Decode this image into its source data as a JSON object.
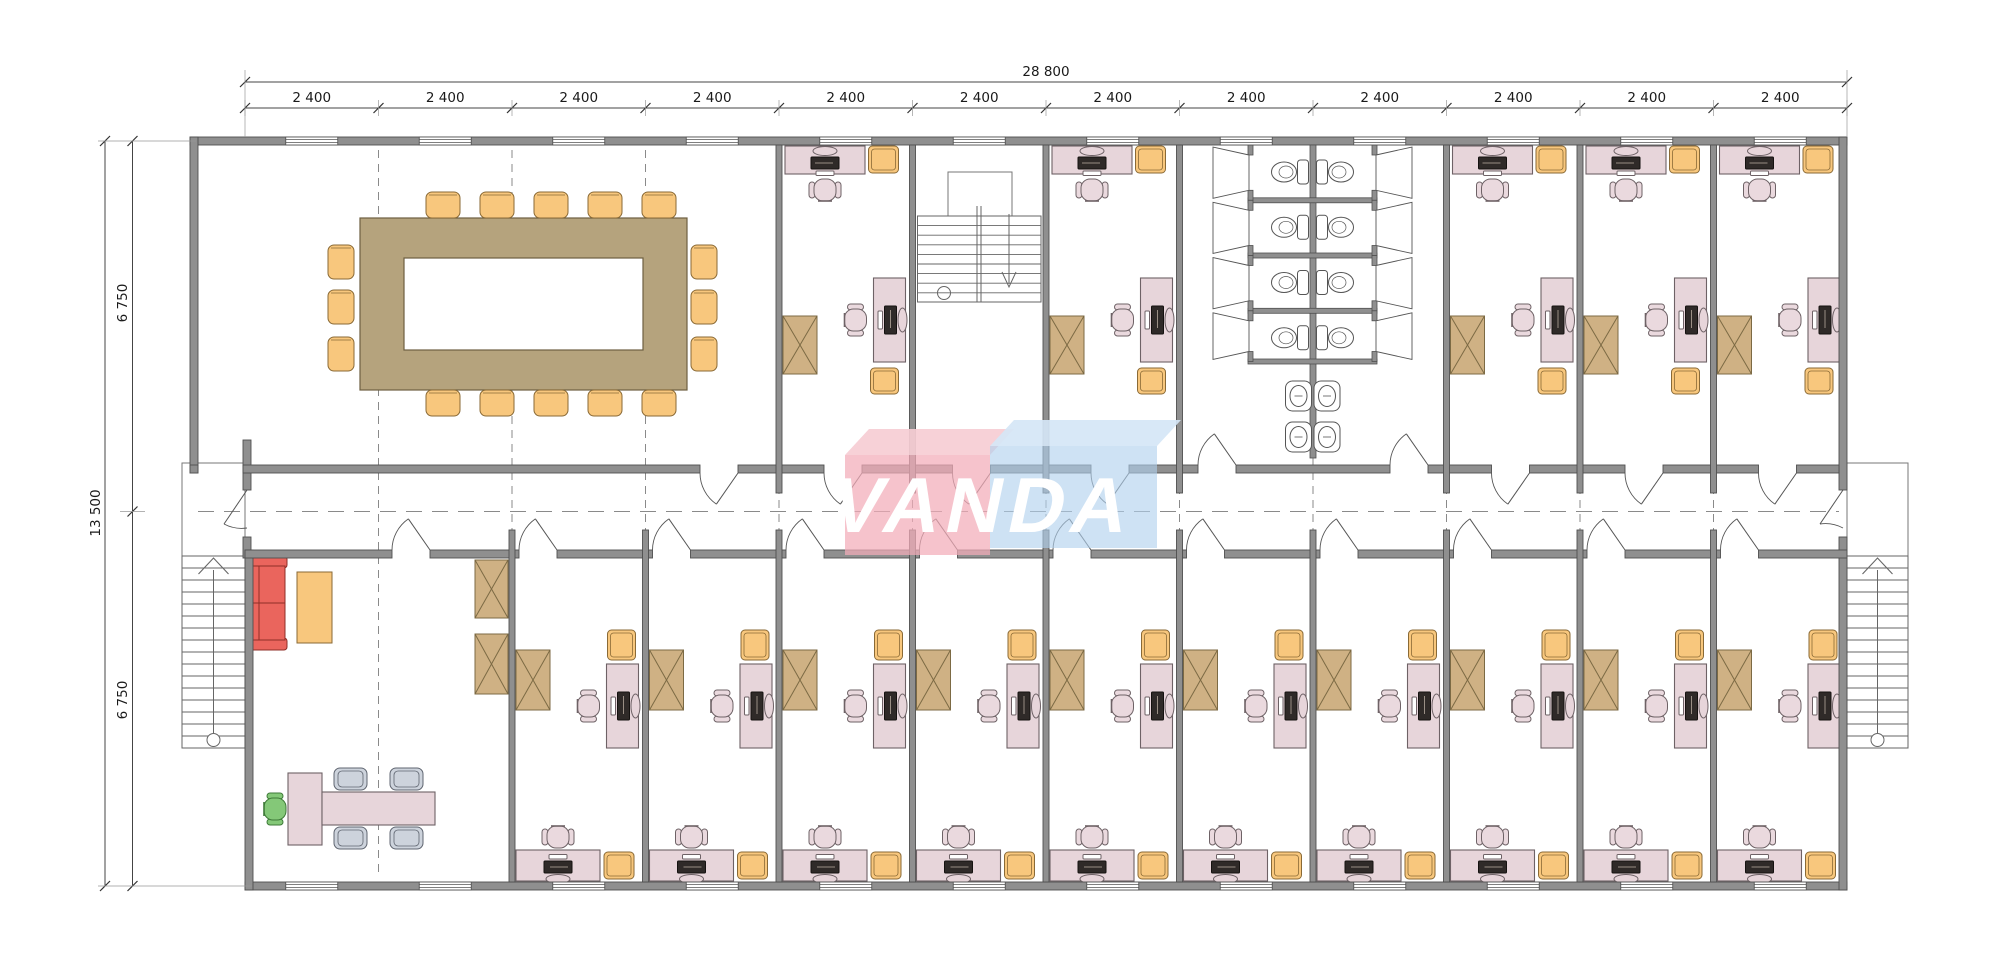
{
  "drawing_title": "Office module building - floor plan",
  "watermark": {
    "text": "VANDA",
    "box_pink": "#f2acb8",
    "box_blue": "#b0d0ee"
  },
  "dimensions": {
    "total_width_label": "28 800",
    "module_label": "2 400",
    "module_count": 12,
    "overall_height_label": "13 500",
    "half_height_label": "6 750"
  },
  "rooms": {
    "top_row": [
      "conference-room",
      "office",
      "stair-hall",
      "office",
      "washroom",
      "office",
      "office",
      "office"
    ],
    "bottom_row": [
      "executive-office",
      "office",
      "office",
      "office",
      "office",
      "office",
      "office",
      "office",
      "office",
      "office",
      "office"
    ]
  },
  "conference_room": {
    "seats": 16
  },
  "washroom": {
    "toilet_stalls": 8,
    "washbasins": 4
  },
  "office_count": 15,
  "colors": {
    "wall": "#8f8f8f",
    "wall_edge": "#4f4f4f",
    "line": "#555555",
    "dash": "#8a8a8a",
    "desk": "#e7d5da",
    "desk_edge": "#6e6266",
    "chair": "#ead9de",
    "armchair": "#f8c77d",
    "armchair_edge": "#8a6a36",
    "cabinet": "#cfb184",
    "cabinet_edge": "#7c6a44",
    "table": "#b5a37d",
    "table_edge": "#6d5f41",
    "sofa": "#ea655d",
    "sofa_edge": "#8f2f28",
    "sofa_back": "#8fb4ae",
    "exec_chair": "#84c878",
    "exec_chair_edge": "#3e7a38",
    "visitor_chair": "#cdd3dc",
    "visitor_chair_edge": "#5f6570",
    "monitor": "#2f2a28",
    "dim_text": "#1a1a1a"
  }
}
